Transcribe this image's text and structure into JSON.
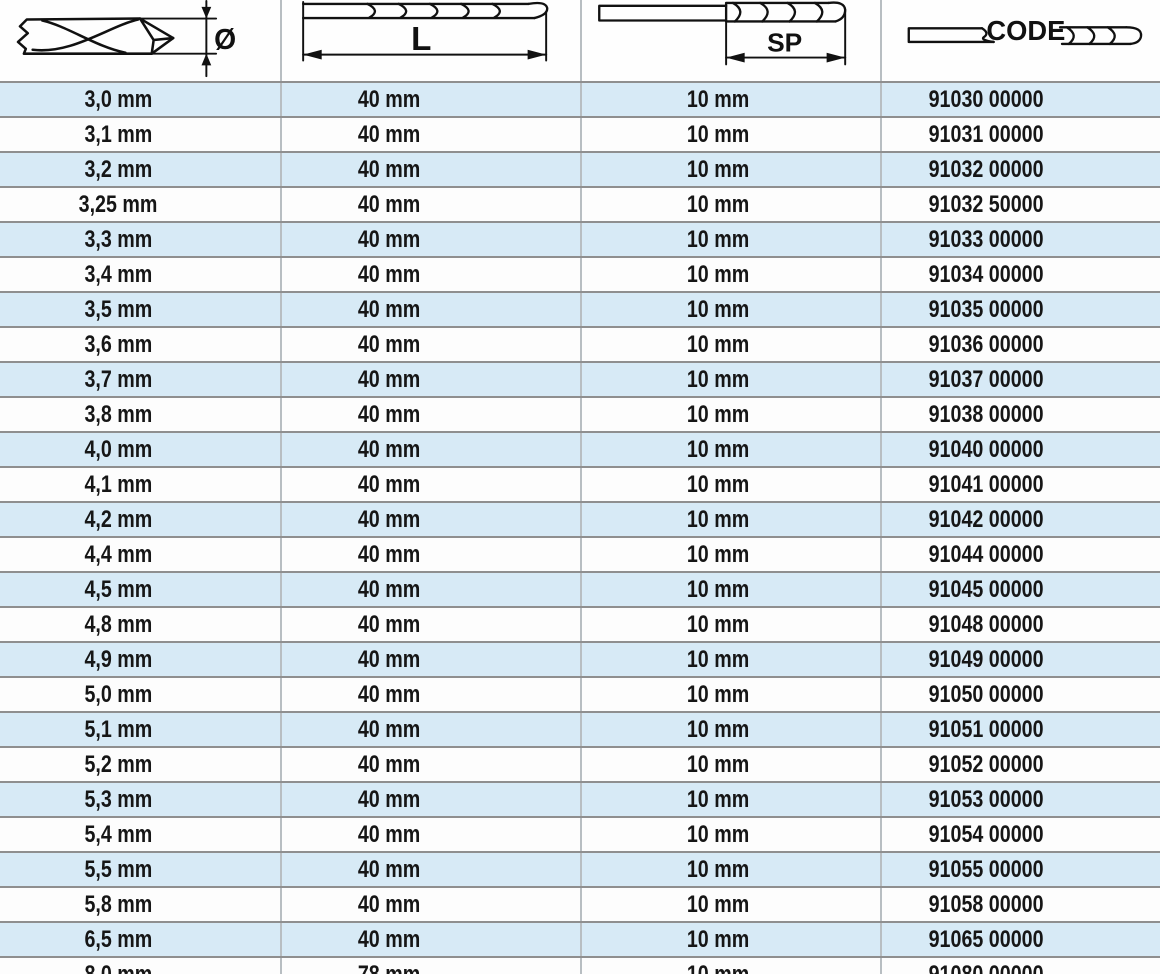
{
  "header": {
    "columns": [
      {
        "label": "Ø",
        "meaning": "diameter"
      },
      {
        "label": "L",
        "meaning": "overall-length"
      },
      {
        "label": "SP",
        "meaning": "spiral-length"
      },
      {
        "label": "CODE",
        "meaning": "article-code"
      }
    ]
  },
  "table": {
    "rows": [
      [
        "3,0 mm",
        "40 mm",
        "10 mm",
        "91030 00000"
      ],
      [
        "3,1 mm",
        "40 mm",
        "10 mm",
        "91031 00000"
      ],
      [
        "3,2 mm",
        "40 mm",
        "10 mm",
        "91032 00000"
      ],
      [
        "3,25 mm",
        "40 mm",
        "10 mm",
        "91032 50000"
      ],
      [
        "3,3 mm",
        "40 mm",
        "10 mm",
        "91033 00000"
      ],
      [
        "3,4 mm",
        "40 mm",
        "10 mm",
        "91034 00000"
      ],
      [
        "3,5 mm",
        "40 mm",
        "10 mm",
        "91035 00000"
      ],
      [
        "3,6 mm",
        "40 mm",
        "10 mm",
        "91036 00000"
      ],
      [
        "3,7 mm",
        "40 mm",
        "10 mm",
        "91037 00000"
      ],
      [
        "3,8 mm",
        "40 mm",
        "10 mm",
        "91038 00000"
      ],
      [
        "4,0 mm",
        "40 mm",
        "10 mm",
        "91040 00000"
      ],
      [
        "4,1 mm",
        "40 mm",
        "10 mm",
        "91041 00000"
      ],
      [
        "4,2 mm",
        "40 mm",
        "10 mm",
        "91042 00000"
      ],
      [
        "4,4 mm",
        "40 mm",
        "10 mm",
        "91044 00000"
      ],
      [
        "4,5 mm",
        "40 mm",
        "10 mm",
        "91045 00000"
      ],
      [
        "4,8 mm",
        "40 mm",
        "10 mm",
        "91048 00000"
      ],
      [
        "4,9 mm",
        "40 mm",
        "10 mm",
        "91049 00000"
      ],
      [
        "5,0 mm",
        "40 mm",
        "10 mm",
        "91050 00000"
      ],
      [
        "5,1 mm",
        "40 mm",
        "10 mm",
        "91051 00000"
      ],
      [
        "5,2 mm",
        "40 mm",
        "10 mm",
        "91052 00000"
      ],
      [
        "5,3 mm",
        "40 mm",
        "10 mm",
        "91053 00000"
      ],
      [
        "5,4 mm",
        "40 mm",
        "10 mm",
        "91054 00000"
      ],
      [
        "5,5 mm",
        "40 mm",
        "10 mm",
        "91055 00000"
      ],
      [
        "5,8 mm",
        "40 mm",
        "10 mm",
        "91058 00000"
      ],
      [
        "6,5 mm",
        "40 mm",
        "10 mm",
        "91065 00000"
      ],
      [
        "8,0 mm",
        "78 mm",
        "10 mm",
        "91080 00000"
      ]
    ]
  },
  "colors": {
    "row-alt": "#d7eaf6",
    "row-base": "#fdfdfd",
    "border": "#8f8f8f",
    "divider": "#b8bec2",
    "text": "#161616"
  }
}
